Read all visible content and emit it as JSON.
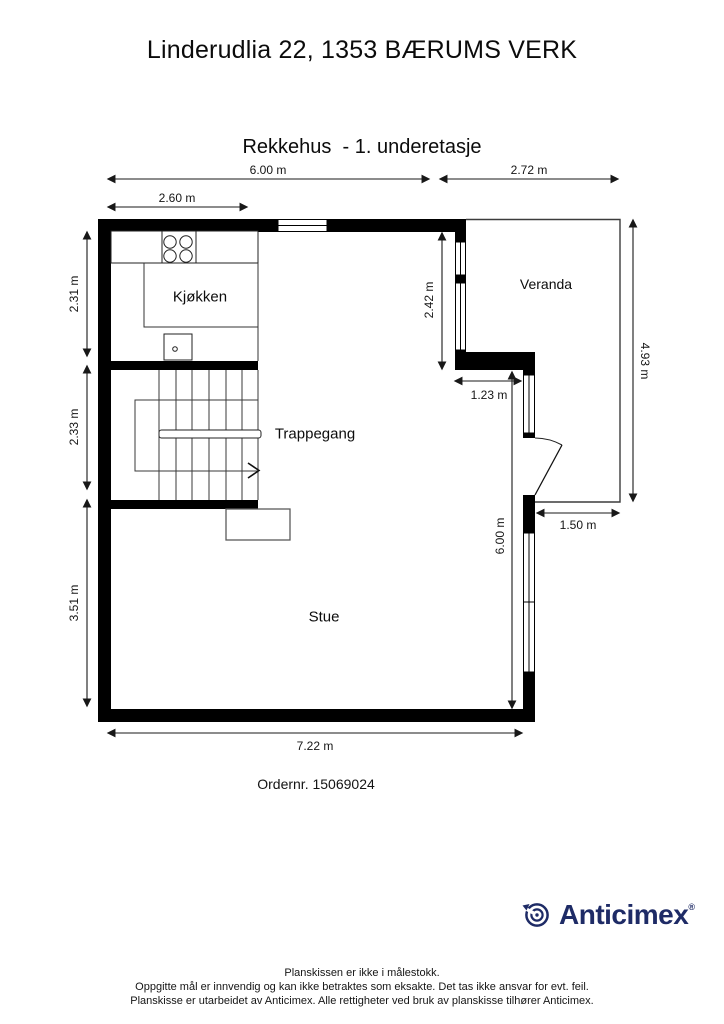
{
  "title": "Linderudlia 22, 1353 BÆRUMS VERK",
  "subtitle": "Rekkehus  - 1. underetasje",
  "rooms": {
    "kitchen": "Kjøkken",
    "stairwell": "Trappegang",
    "living_room": "Stue",
    "veranda": "Veranda"
  },
  "dimensions": {
    "top_width": "6.00 m",
    "veranda_width": "2.72 m",
    "kitchen_width": "2.60 m",
    "kitchen_depth": "2.31 m",
    "stairwell_depth": "2.33 m",
    "living_depth": "3.51 m",
    "kitchen_right_height": "2.42 m",
    "veranda_height": "4.93 m",
    "passage_width": "1.23 m",
    "living_height": "6.00 m",
    "veranda_bottom_width": "1.50 m",
    "bottom_width": "7.22 m"
  },
  "order_number_label": "Ordernr. 15069024",
  "logo": {
    "brand": "Anticimex",
    "registered_mark": "®",
    "brand_color": "#1e2b66"
  },
  "plan": {
    "wall_color": "#000000",
    "background": "#ffffff"
  },
  "footer": {
    "line1": "Planskissen er ikke i målestokk.",
    "line2": "Oppgitte mål er innvendig og kan ikke betraktes som eksakte. Det tas ikke ansvar for evt. feil.",
    "line3": "Planskisse er utarbeidet av Anticimex. Alle rettigheter ved bruk av planskisse tilhører Anticimex."
  }
}
